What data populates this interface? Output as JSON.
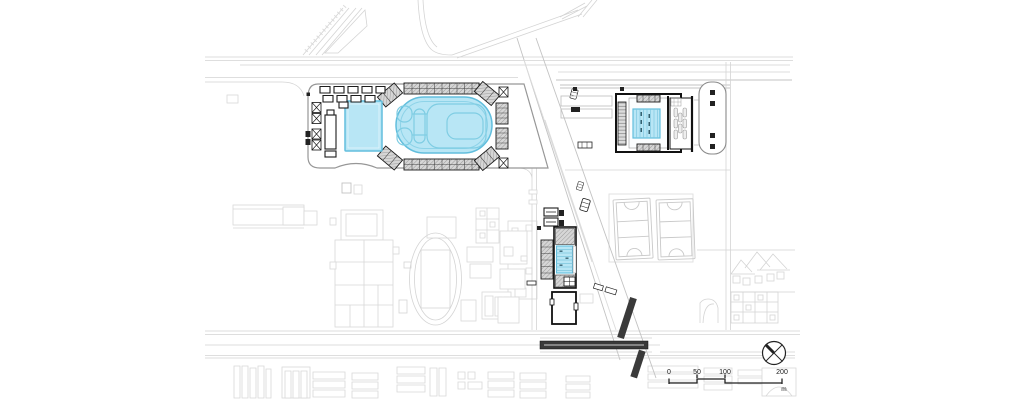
{
  "colors": {
    "pool_fill": "#b8e6f5",
    "pool_stroke": "#62bedd",
    "pool_channel": "#7fcde3",
    "dark_structure": "#3a3a3a",
    "background_line": "#d4d4d4",
    "ink": "#1c1c1c"
  },
  "scale_bar": {
    "ticks": [
      "0",
      "50",
      "100",
      "200"
    ],
    "unit": "m"
  },
  "icons": {
    "north_arrow": "north-arrow-icon"
  }
}
